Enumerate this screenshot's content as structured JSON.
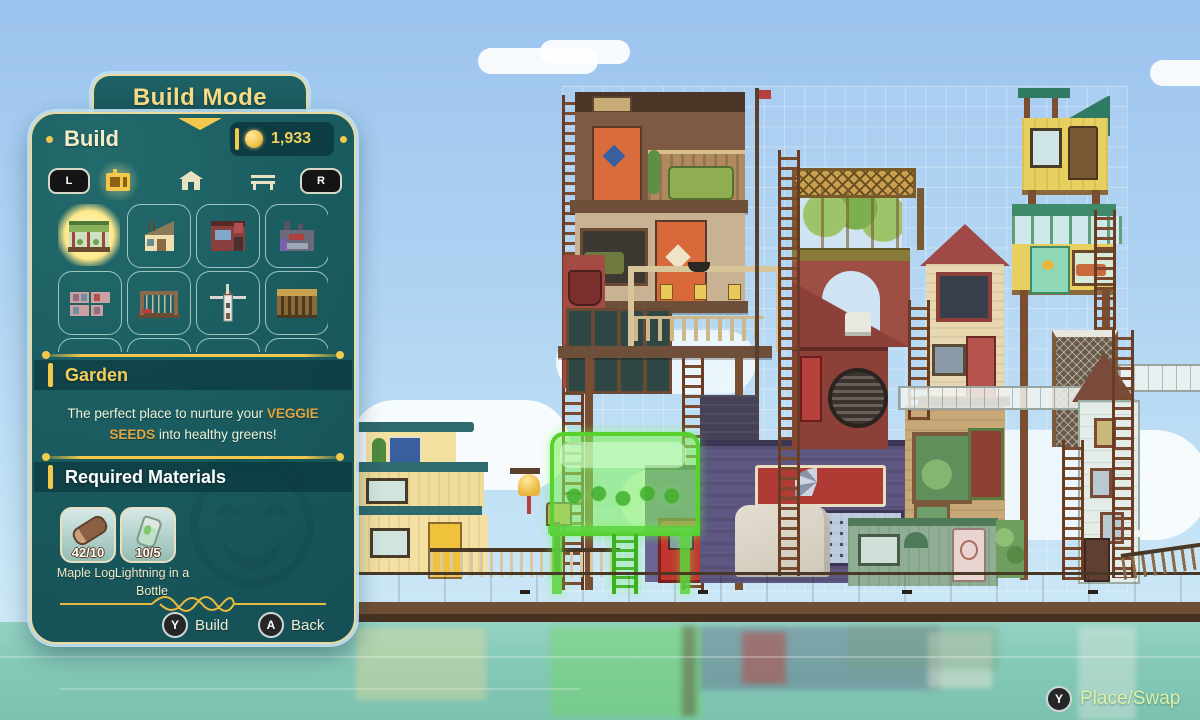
{
  "colors": {
    "panel_teal": "#1a5c60",
    "gold_trim": "#f2c94c",
    "title_gold": "#f6dd85",
    "highlight_orange": "#e5a33c",
    "sky_blue": "#a9cdf1",
    "water_teal": "#84c8b6",
    "placement_green": "#57d12e"
  },
  "build_panel": {
    "mode_title": "Build Mode",
    "tab_title": "Build",
    "currency_amount": "1,933",
    "shoulder_left": "L",
    "shoulder_right": "R",
    "selected_item": {
      "name": "Garden",
      "desc_before": "The perfect place to nurture your ",
      "desc_highlight": "VEGGIE SEEDS",
      "desc_after": " into healthy greens!"
    },
    "required_materials": {
      "title": "Required Materials",
      "items": [
        {
          "name": "Maple Log",
          "count": "42/10",
          "icon": "log-icon"
        },
        {
          "name": "Lightning in a Bottle",
          "count": "10/5",
          "icon": "bottle-icon"
        }
      ]
    },
    "actions": {
      "build": {
        "button": "Y",
        "label": "Build"
      },
      "back": {
        "button": "A",
        "label": "Back"
      }
    }
  },
  "hud": {
    "place_hint": {
      "button": "Y",
      "label": "Place/Swap"
    }
  }
}
